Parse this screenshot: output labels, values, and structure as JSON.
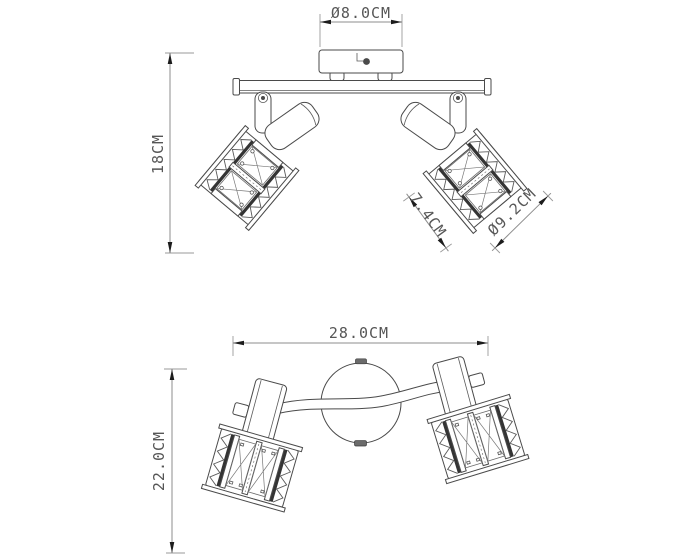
{
  "dims": {
    "canopy_diameter": "Ø8.0CM",
    "height": "18CM",
    "shade_depth": "7.4CM",
    "shade_diameter": "Ø9.2CM",
    "width": "28.0CM",
    "depth": "22.0CM"
  },
  "colors": {
    "background": "#ffffff",
    "line": "#4a4a4a",
    "dim_line": "#8d8d8d",
    "arrow": "#1c1c1c",
    "text": "#565656",
    "dark_fill": "#343434"
  }
}
